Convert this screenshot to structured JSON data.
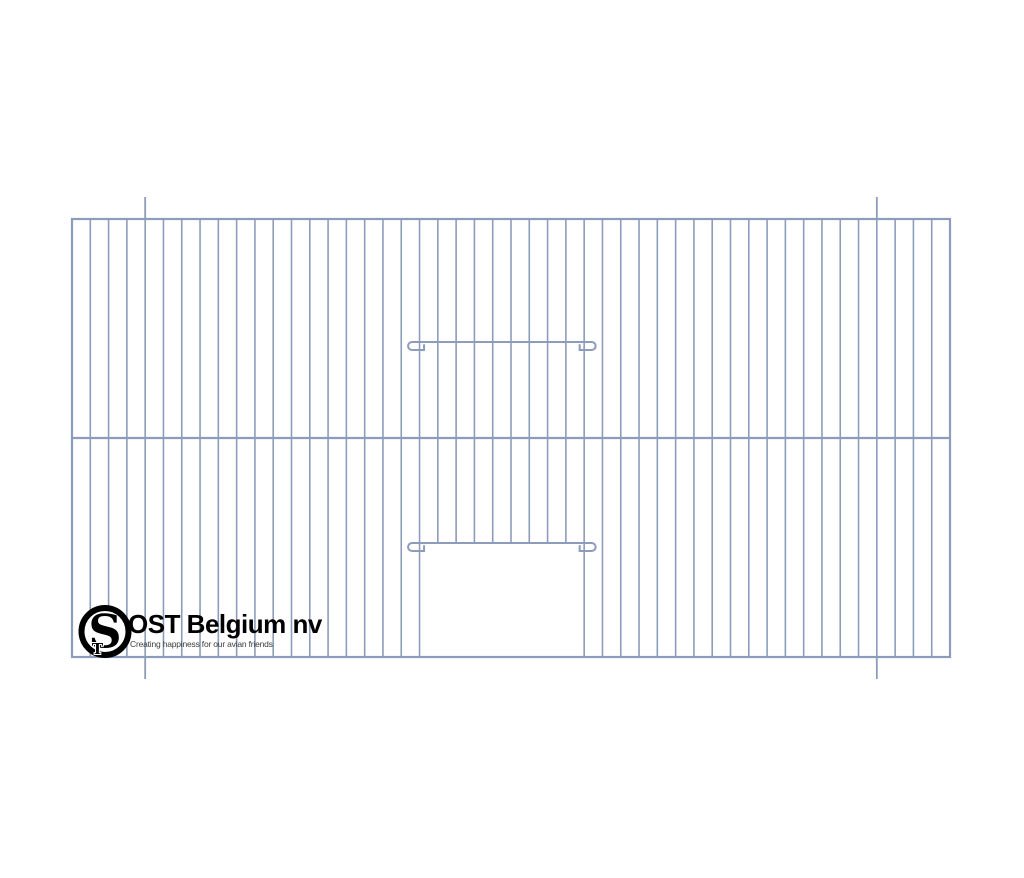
{
  "canvas": {
    "width": 1024,
    "height": 878,
    "background": "#ffffff"
  },
  "drawing": {
    "description": "cage-front-panel-technical-drawing",
    "line_color": "#8d9cba",
    "frame_stroke_width": 2.2,
    "bar_stroke_width": 1.6,
    "latch_stroke_width": 2,
    "fold_mark_stroke_width": 1.8,
    "panel": {
      "x": 72,
      "y": 219,
      "width": 878,
      "height": 438
    },
    "bar_gap_count": 48,
    "middle_rail_y": 438,
    "door": {
      "left_bar_index": 19,
      "right_bar_index": 28,
      "opening_top_y": 543
    },
    "latch_wires": [
      {
        "y": 342
      },
      {
        "y": 543
      }
    ],
    "latch_shape": {
      "end_overhang": 7.5,
      "drop": 8,
      "arc_radius": 4,
      "tick_inset": 12,
      "tick_top_offset": 3,
      "tick_bottom_offset": 12
    },
    "fold_marks": {
      "bar_indices": [
        4,
        44
      ],
      "length": 22
    }
  },
  "logo": {
    "ring_color": "#000000",
    "ring_fill": "#ffffff",
    "monogram": {
      "s": "S",
      "t": "T"
    },
    "brand_name": "OST Belgium nv",
    "brand_color": "#000000",
    "tagline": "Creating happiness for our avian friends",
    "tagline_color": "#3d3d3d"
  }
}
